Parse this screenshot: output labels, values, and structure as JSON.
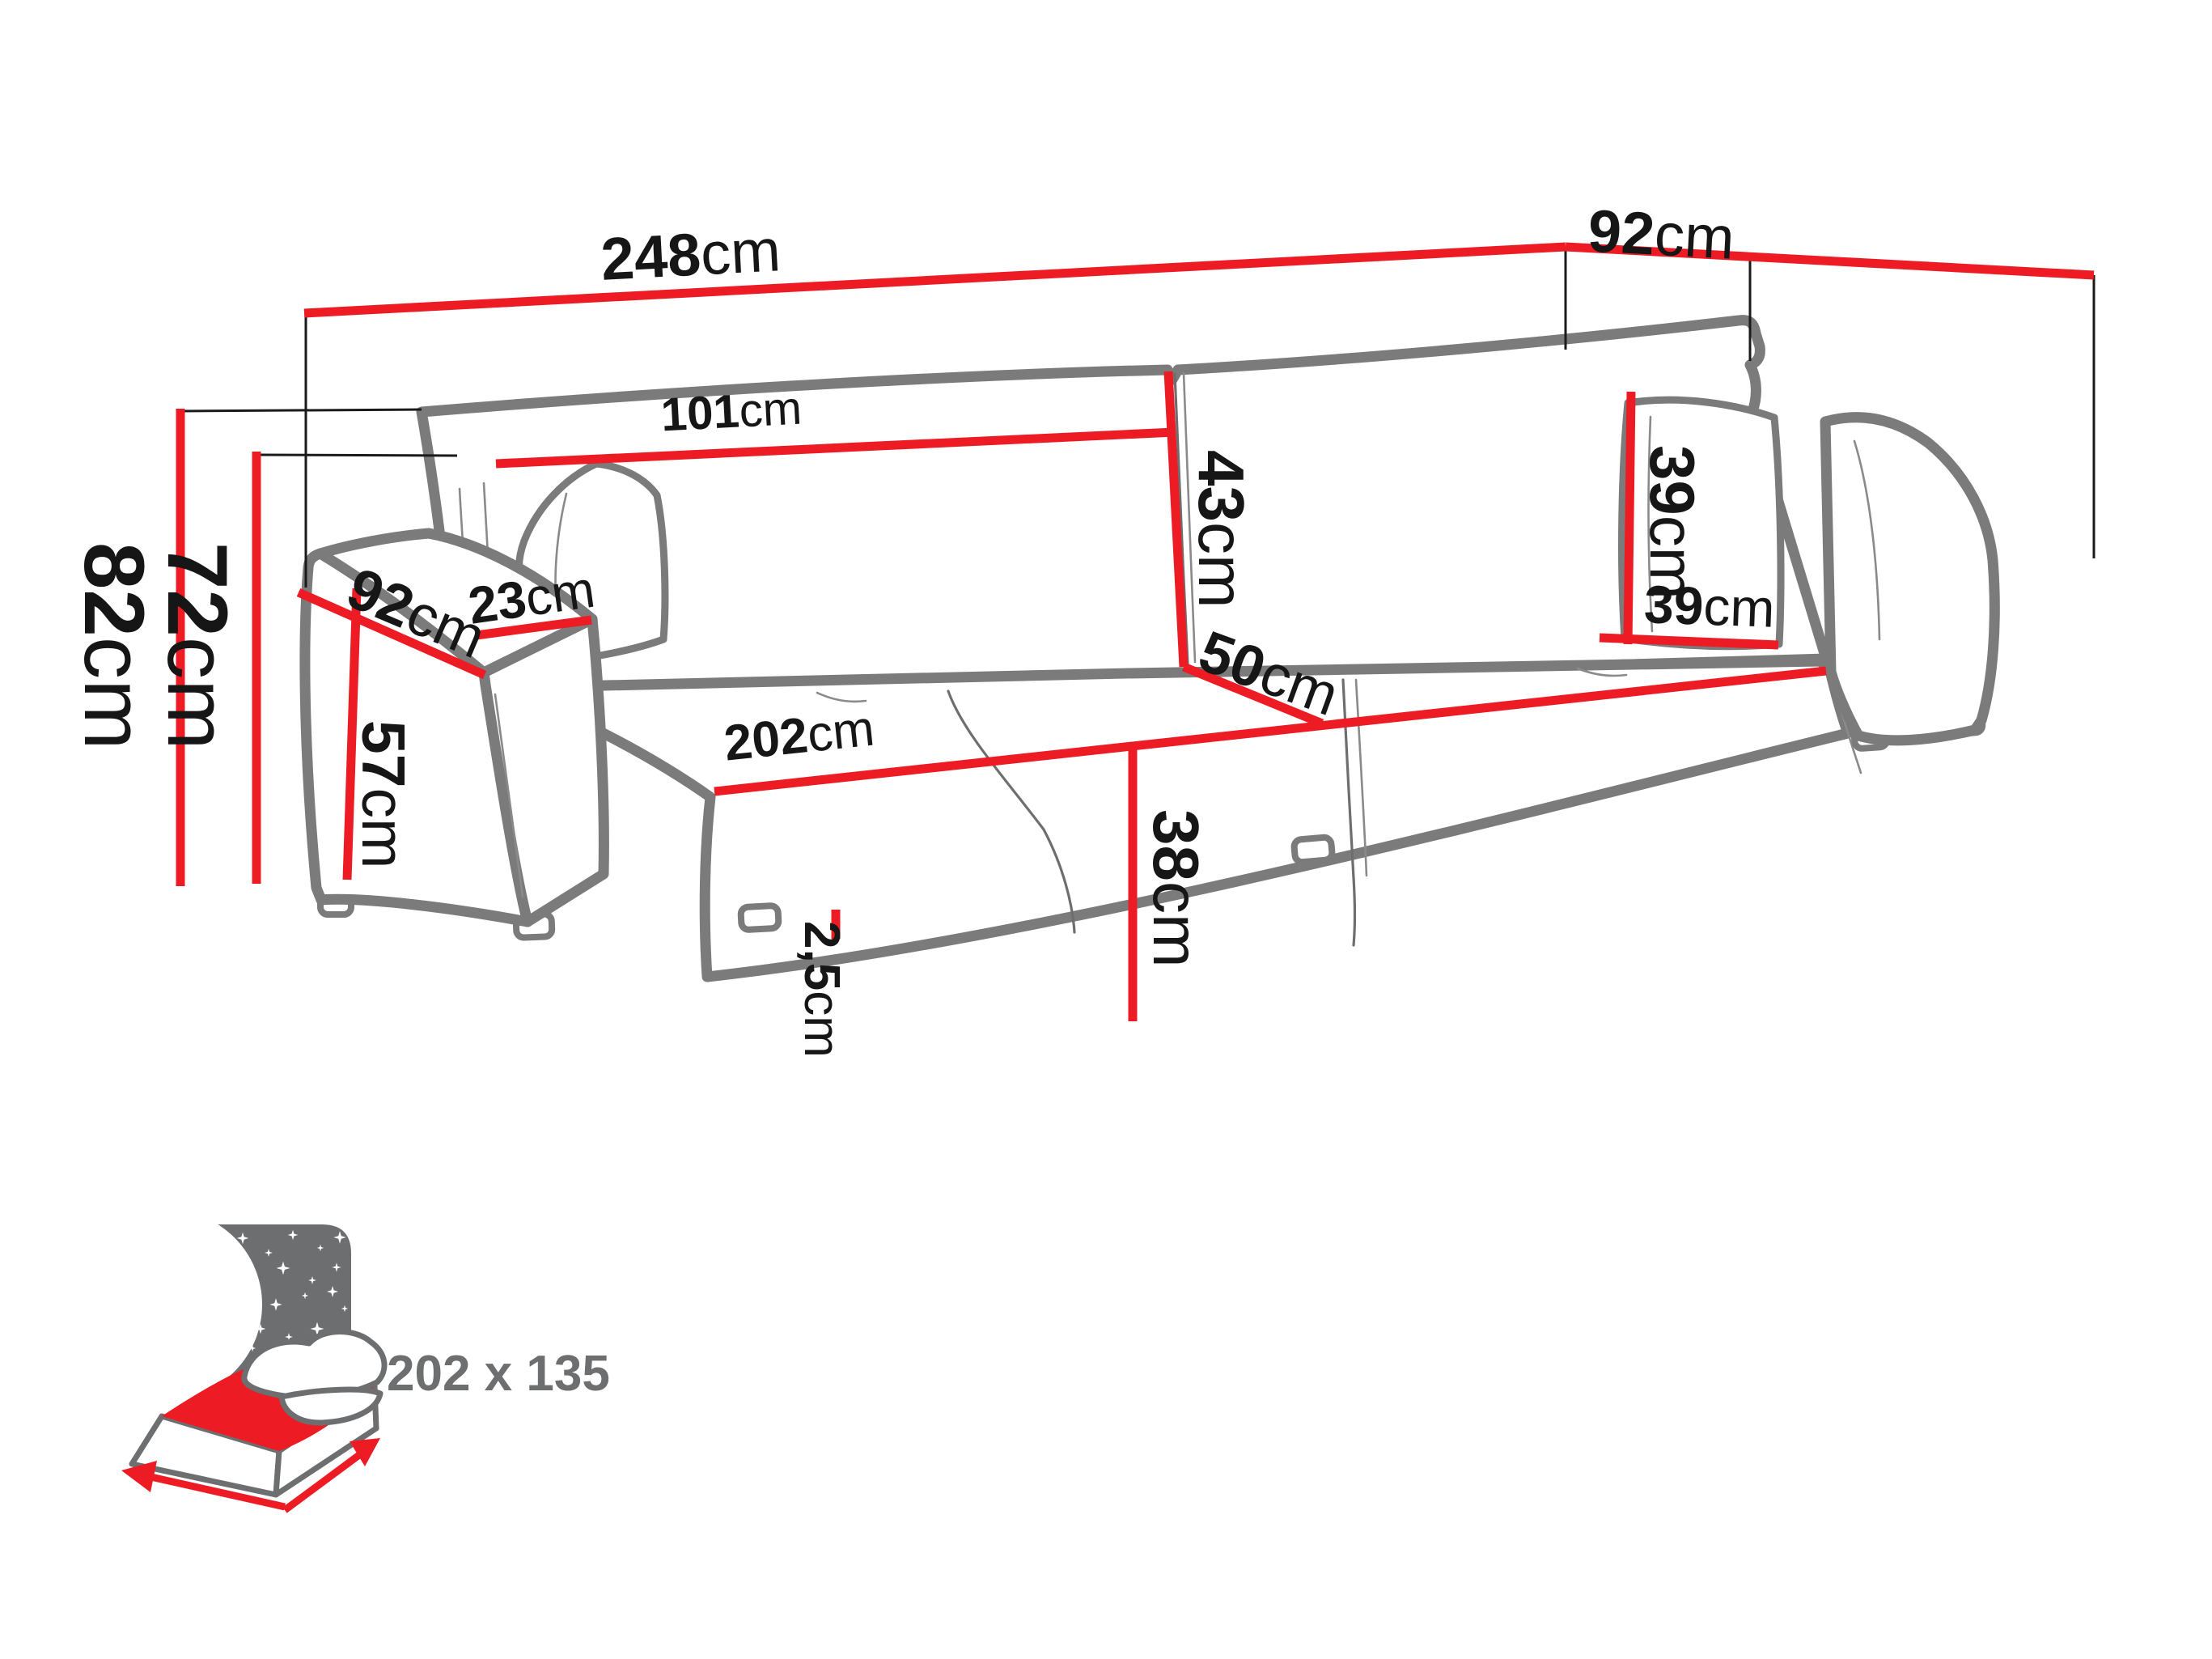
{
  "colors": {
    "dimension_red": "#ED1C24",
    "outline_gray": "#7B7B7B",
    "thin_line": "#1A1A1A",
    "icon_gray": "#6D6E70",
    "background": "#FFFFFF"
  },
  "diagram": {
    "type": "sofa-dimension-drawing",
    "dims": {
      "overall_width": {
        "value": "248",
        "unit": "cm"
      },
      "overall_depth": {
        "value": "92",
        "unit": "cm"
      },
      "backrest_width": {
        "value": "101",
        "unit": "cm"
      },
      "back_cushion_height": {
        "value": "43",
        "unit": "cm"
      },
      "pillow_height": {
        "value": "39",
        "unit": "cm"
      },
      "pillow_width": {
        "value": "39",
        "unit": "cm"
      },
      "armrest_depth": {
        "value": "92",
        "unit": "cm"
      },
      "armrest_width": {
        "value": "23",
        "unit": "cm"
      },
      "armrest_height": {
        "value": "57",
        "unit": "cm"
      },
      "seat_width": {
        "value": "202",
        "unit": "cm"
      },
      "seat_depth": {
        "value": "50",
        "unit": "cm"
      },
      "seat_height": {
        "value": "38",
        "unit": "cm"
      },
      "total_height": {
        "value": "82",
        "unit": "cm"
      },
      "frame_height": {
        "value": "72",
        "unit": "cm"
      },
      "leg_height": {
        "value": "2,5",
        "unit": "cm"
      }
    },
    "sleeping_area": {
      "label": "202 x 135"
    }
  }
}
